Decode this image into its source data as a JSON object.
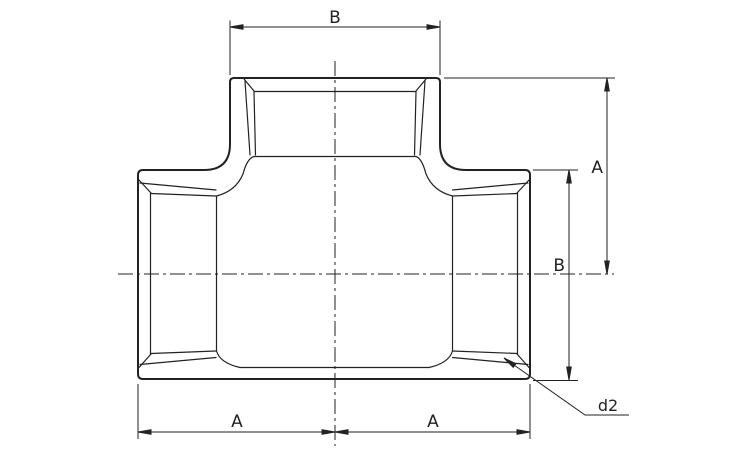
{
  "drawing": {
    "type": "technical-drawing",
    "subject": "threaded pipe tee fitting, front elevation section",
    "background_color": "#ffffff",
    "line_color": "#222222",
    "labels": {
      "top_width": "B",
      "branch_height": "A",
      "body_height": "B",
      "bottom_left_width": "A",
      "bottom_right_width": "A",
      "edge_leader": "d2"
    }
  }
}
